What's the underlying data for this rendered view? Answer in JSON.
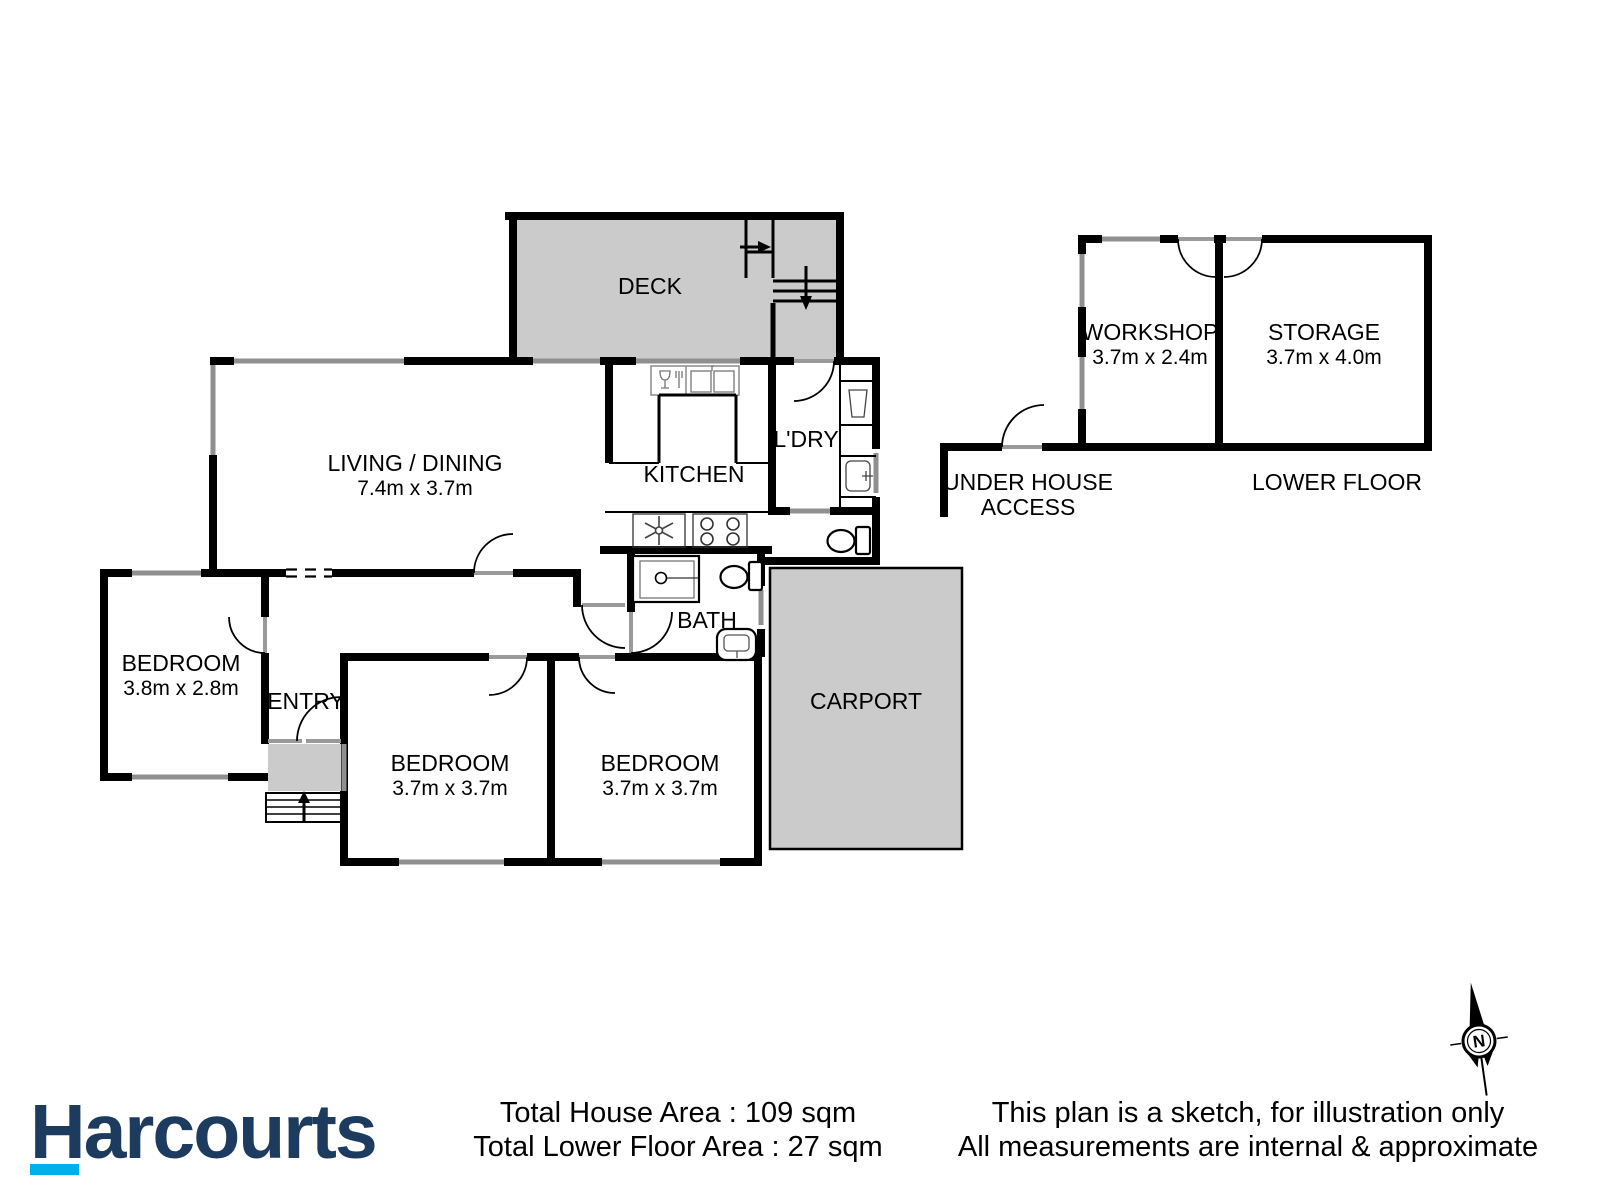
{
  "plan": {
    "upper": {
      "deck": {
        "label": "DECK"
      },
      "living_dining": {
        "label": "LIVING / DINING",
        "size": "7.4m x 3.7m"
      },
      "kitchen": {
        "label": "KITCHEN"
      },
      "laundry": {
        "label": "L'DRY"
      },
      "bath": {
        "label": "BATH"
      },
      "bedroom_1": {
        "label": "BEDROOM",
        "size": "3.8m x 2.8m"
      },
      "entry": {
        "label": "ENTRY"
      },
      "bedroom_2": {
        "label": "BEDROOM",
        "size": "3.7m x 3.7m"
      },
      "bedroom_3": {
        "label": "BEDROOM",
        "size": "3.7m x 3.7m"
      },
      "carport": {
        "label": "CARPORT"
      }
    },
    "lower": {
      "workshop": {
        "label": "WORKSHOP",
        "size": "3.7m x 2.4m"
      },
      "storage": {
        "label": "STORAGE",
        "size": "3.7m x 4.0m"
      },
      "under_house_line1": "UNDER HOUSE",
      "under_house_line2": "ACCESS",
      "lower_floor": "LOWER FLOOR"
    },
    "compass": {
      "north": "N"
    }
  },
  "footer": {
    "brand": "Harcourts",
    "total_house_area": "Total House Area : 109 sqm",
    "total_lower_floor_area": "Total Lower Floor Area : 27 sqm",
    "disclaimer_line1": "This plan is a sketch, for illustration only",
    "disclaimer_line2": "All measurements are internal & approximate"
  },
  "colors": {
    "wall_black": "#000000",
    "floor_area_grey": "#cbcbcb",
    "window_grey": "#8f8f8f",
    "brand_navy": "#1d3b5e",
    "brand_cyan": "#00aeef"
  }
}
